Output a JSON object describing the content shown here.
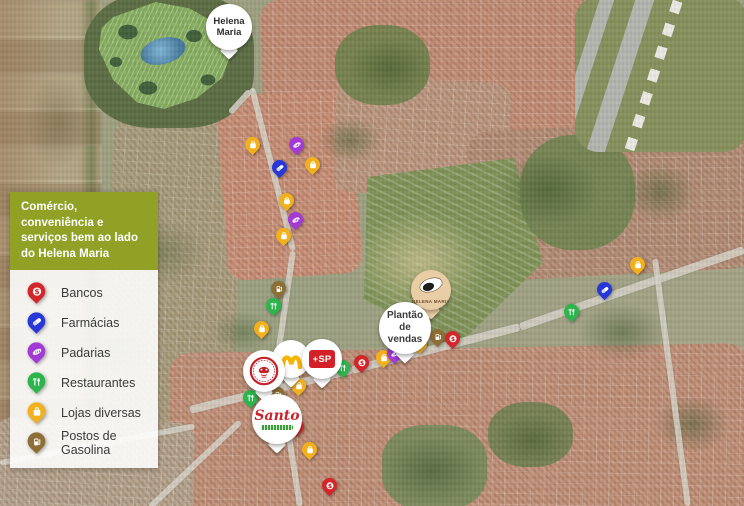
{
  "legend": {
    "title": "Comércio, conveniência e serviços bem ao lado do Helena Maria",
    "panel_color": "#90a125",
    "items": [
      {
        "id": "banco",
        "label": "Bancos",
        "color": "#d2262b",
        "icon": "dollar-sign-icon"
      },
      {
        "id": "farmacia",
        "label": "Farmácias",
        "color": "#2838d8",
        "icon": "pill-icon"
      },
      {
        "id": "padaria",
        "label": "Padarias",
        "color": "#a43ad6",
        "icon": "bread-icon"
      },
      {
        "id": "restaurante",
        "label": "Restaurantes",
        "color": "#2db44c",
        "icon": "cutlery-icon"
      },
      {
        "id": "loja",
        "label": "Lojas diversas",
        "color": "#f2b01c",
        "icon": "shopping-bag-icon"
      },
      {
        "id": "posto",
        "label": "Postos de Gasolina",
        "color": "#8d6e35",
        "icon": "fuel-pump-icon"
      }
    ]
  },
  "map": {
    "labels": {
      "development": "Helena Maria",
      "sales": "Plantão de vendas",
      "drogaria": "+SP",
      "santo": "Santo",
      "helena_logo": "HELENA MARIA"
    },
    "logo_pins": [
      {
        "id": "development-label",
        "icon": "map-pin",
        "x": 229,
        "y": 58,
        "size": 46
      },
      {
        "id": "habibs",
        "icon": "habibs-logo-icon",
        "x": 264,
        "y": 400,
        "size": 42
      },
      {
        "id": "mcdonalds",
        "icon": "golden-arches-icon",
        "x": 291,
        "y": 386,
        "size": 38
      },
      {
        "id": "drogaria-sp",
        "icon": "drogaria-sp-logo-icon",
        "x": 322,
        "y": 387,
        "size": 40
      },
      {
        "id": "santo",
        "icon": "santo-logo-icon",
        "x": 277,
        "y": 452,
        "size": 50
      },
      {
        "id": "sales-office",
        "icon": "map-pin",
        "x": 405,
        "y": 362,
        "size": 52
      },
      {
        "id": "helena-maria-logo",
        "icon": "helena-maria-logo-icon",
        "x": 431,
        "y": 318,
        "size": 40
      }
    ],
    "markers": [
      {
        "type": "loja",
        "x": 253,
        "y": 147
      },
      {
        "type": "padaria",
        "x": 297,
        "y": 147
      },
      {
        "type": "loja",
        "x": 313,
        "y": 167
      },
      {
        "type": "farmacia",
        "x": 280,
        "y": 170
      },
      {
        "type": "loja",
        "x": 287,
        "y": 203
      },
      {
        "type": "padaria",
        "x": 296,
        "y": 222
      },
      {
        "type": "loja",
        "x": 284,
        "y": 238
      },
      {
        "type": "posto",
        "x": 279,
        "y": 291
      },
      {
        "type": "restaurante",
        "x": 274,
        "y": 308
      },
      {
        "type": "loja",
        "x": 262,
        "y": 331
      },
      {
        "type": "loja",
        "x": 299,
        "y": 388
      },
      {
        "type": "posto",
        "x": 278,
        "y": 397
      },
      {
        "type": "restaurante",
        "x": 251,
        "y": 400
      },
      {
        "type": "banco",
        "x": 297,
        "y": 429
      },
      {
        "type": "loja",
        "x": 310,
        "y": 452
      },
      {
        "type": "banco",
        "x": 330,
        "y": 488
      },
      {
        "type": "restaurante",
        "x": 343,
        "y": 370
      },
      {
        "type": "banco",
        "x": 362,
        "y": 365
      },
      {
        "type": "loja",
        "x": 384,
        "y": 360
      },
      {
        "type": "padaria",
        "x": 395,
        "y": 356
      },
      {
        "type": "loja",
        "x": 420,
        "y": 346
      },
      {
        "type": "posto",
        "x": 438,
        "y": 339
      },
      {
        "type": "banco",
        "x": 453,
        "y": 341
      },
      {
        "type": "loja",
        "x": 638,
        "y": 267
      },
      {
        "type": "farmacia",
        "x": 605,
        "y": 292
      },
      {
        "type": "restaurante",
        "x": 572,
        "y": 314
      }
    ]
  }
}
